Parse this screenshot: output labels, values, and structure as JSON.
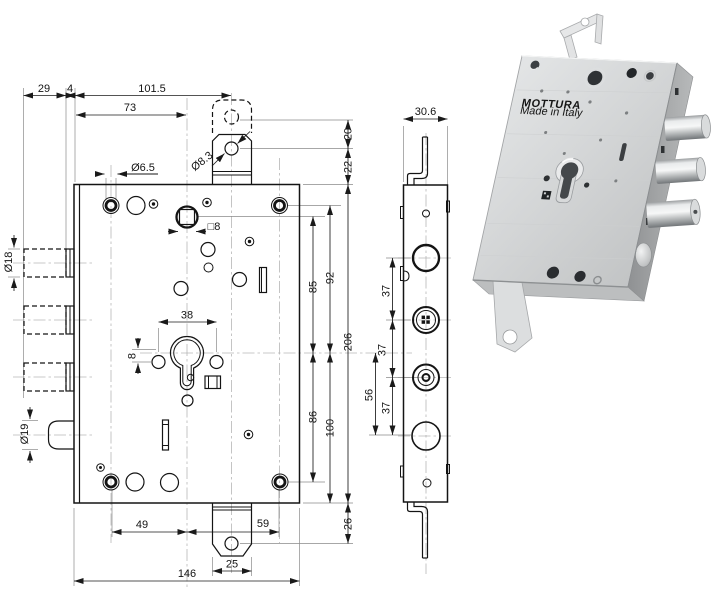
{
  "drawing": {
    "front": {
      "d29": "29",
      "d4": "4",
      "d101_5": "101.5",
      "d73": "73",
      "dia6_5": "Ø6.5",
      "dia8_3": "Ø8.3",
      "d20": "20",
      "d22": "22",
      "sq8": "□8",
      "d85": "85",
      "d92": "92",
      "d206": "206",
      "d38": "38",
      "d8": "8",
      "dia18": "Ø18",
      "dia19": "Ø19",
      "d86": "86",
      "d100": "100",
      "d26": "26",
      "d49": "49",
      "d59": "59",
      "d25": "25",
      "d146": "146"
    },
    "side": {
      "d30_6": "30.6",
      "d37_1": "37",
      "d37_2": "37",
      "d37_3": "37",
      "d56": "56"
    },
    "photo": {
      "brand": "MOTTURA",
      "made_in": "Made in Italy"
    },
    "colors": {
      "line": "#1a1a1a",
      "construction": "#b6b6b6",
      "metal_light": "#e2e4e5",
      "metal_dark": "#8f9193",
      "bolt_chrome": "#f5f6f6"
    }
  }
}
